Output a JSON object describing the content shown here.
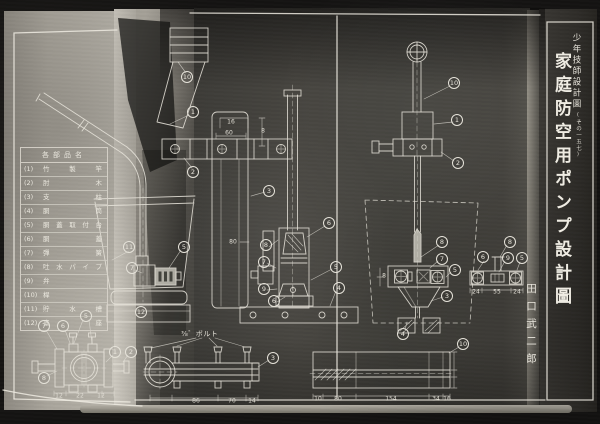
{
  "document": {
    "series": "少年技師設計圖",
    "series_note": "(その一五七)",
    "title": "家庭防空用ポンプ設計圖",
    "author": "田口武二郎"
  },
  "parts_table": {
    "header": "各部品名",
    "rows": [
      {
        "no": "(1)",
        "name": "竹製竿"
      },
      {
        "no": "(2)",
        "name": "肘木"
      },
      {
        "no": "(3)",
        "name": "支柱"
      },
      {
        "no": "(4)",
        "name": "胴筒"
      },
      {
        "no": "(5)",
        "name": "胴蓋取付台"
      },
      {
        "no": "(6)",
        "name": "胴蓋"
      },
      {
        "no": "(7)",
        "name": "彈簧"
      },
      {
        "no": "(8)",
        "name": "吐水パイプ"
      },
      {
        "no": "(9)",
        "name": "弁"
      },
      {
        "no": "(10)",
        "name": "桿"
      },
      {
        "no": "(11)",
        "name": "貯水槽"
      },
      {
        "no": "(12)",
        "name": "臺座"
      }
    ]
  },
  "annotations": {
    "bolt_note": "⅜゛ボルト"
  },
  "callouts": [
    {
      "n": "11",
      "x": 129,
      "y": 247
    },
    {
      "n": "7",
      "x": 132,
      "y": 268
    },
    {
      "n": "5",
      "x": 184,
      "y": 247
    },
    {
      "n": "12",
      "x": 141,
      "y": 312
    },
    {
      "n": "10",
      "x": 187,
      "y": 77
    },
    {
      "n": "1",
      "x": 193,
      "y": 112
    },
    {
      "n": "2",
      "x": 193,
      "y": 172
    },
    {
      "n": "3",
      "x": 269,
      "y": 191
    },
    {
      "n": "8",
      "x": 266,
      "y": 245
    },
    {
      "n": "7",
      "x": 264,
      "y": 262
    },
    {
      "n": "9",
      "x": 264,
      "y": 289
    },
    {
      "n": "6",
      "x": 274,
      "y": 301
    },
    {
      "n": "6",
      "x": 329,
      "y": 223
    },
    {
      "n": "5",
      "x": 336,
      "y": 267
    },
    {
      "n": "4",
      "x": 339,
      "y": 288
    },
    {
      "n": "10",
      "x": 454,
      "y": 83
    },
    {
      "n": "1",
      "x": 457,
      "y": 120
    },
    {
      "n": "2",
      "x": 458,
      "y": 163
    },
    {
      "n": "8",
      "x": 442,
      "y": 242
    },
    {
      "n": "7",
      "x": 442,
      "y": 259
    },
    {
      "n": "5",
      "x": 455,
      "y": 270
    },
    {
      "n": "3",
      "x": 447,
      "y": 296
    },
    {
      "n": "4",
      "x": 403,
      "y": 334
    },
    {
      "n": "8",
      "x": 510,
      "y": 242
    },
    {
      "n": "6",
      "x": 483,
      "y": 257
    },
    {
      "n": "9",
      "x": 508,
      "y": 258
    },
    {
      "n": "5",
      "x": 522,
      "y": 258
    },
    {
      "n": "5",
      "x": 86,
      "y": 316
    },
    {
      "n": "7",
      "x": 44,
      "y": 326
    },
    {
      "n": "6",
      "x": 63,
      "y": 326
    },
    {
      "n": "1",
      "x": 115,
      "y": 352
    },
    {
      "n": "2",
      "x": 131,
      "y": 352
    },
    {
      "n": "8",
      "x": 44,
      "y": 378
    },
    {
      "n": "3",
      "x": 273,
      "y": 358
    },
    {
      "n": "10",
      "x": 463,
      "y": 344
    }
  ],
  "dimensions": [
    {
      "t": "16",
      "x": 231,
      "y": 122
    },
    {
      "t": "60",
      "x": 229,
      "y": 133
    },
    {
      "t": "8",
      "x": 263,
      "y": 131
    },
    {
      "t": "80",
      "x": 233,
      "y": 242
    },
    {
      "t": "8",
      "x": 384,
      "y": 276
    },
    {
      "t": "24",
      "x": 476,
      "y": 292
    },
    {
      "t": "55",
      "x": 497,
      "y": 292
    },
    {
      "t": "24",
      "x": 517,
      "y": 292
    },
    {
      "t": "12",
      "x": 59,
      "y": 396
    },
    {
      "t": "22",
      "x": 80,
      "y": 396
    },
    {
      "t": "12",
      "x": 101,
      "y": 396
    },
    {
      "t": "86",
      "x": 196,
      "y": 401
    },
    {
      "t": "70",
      "x": 232,
      "y": 401
    },
    {
      "t": "14",
      "x": 252,
      "y": 401
    },
    {
      "t": "10",
      "x": 318,
      "y": 399
    },
    {
      "t": "80",
      "x": 338,
      "y": 399
    },
    {
      "t": "154",
      "x": 391,
      "y": 399
    },
    {
      "t": "34",
      "x": 436,
      "y": 399
    },
    {
      "t": "16",
      "x": 447,
      "y": 399
    }
  ]
}
